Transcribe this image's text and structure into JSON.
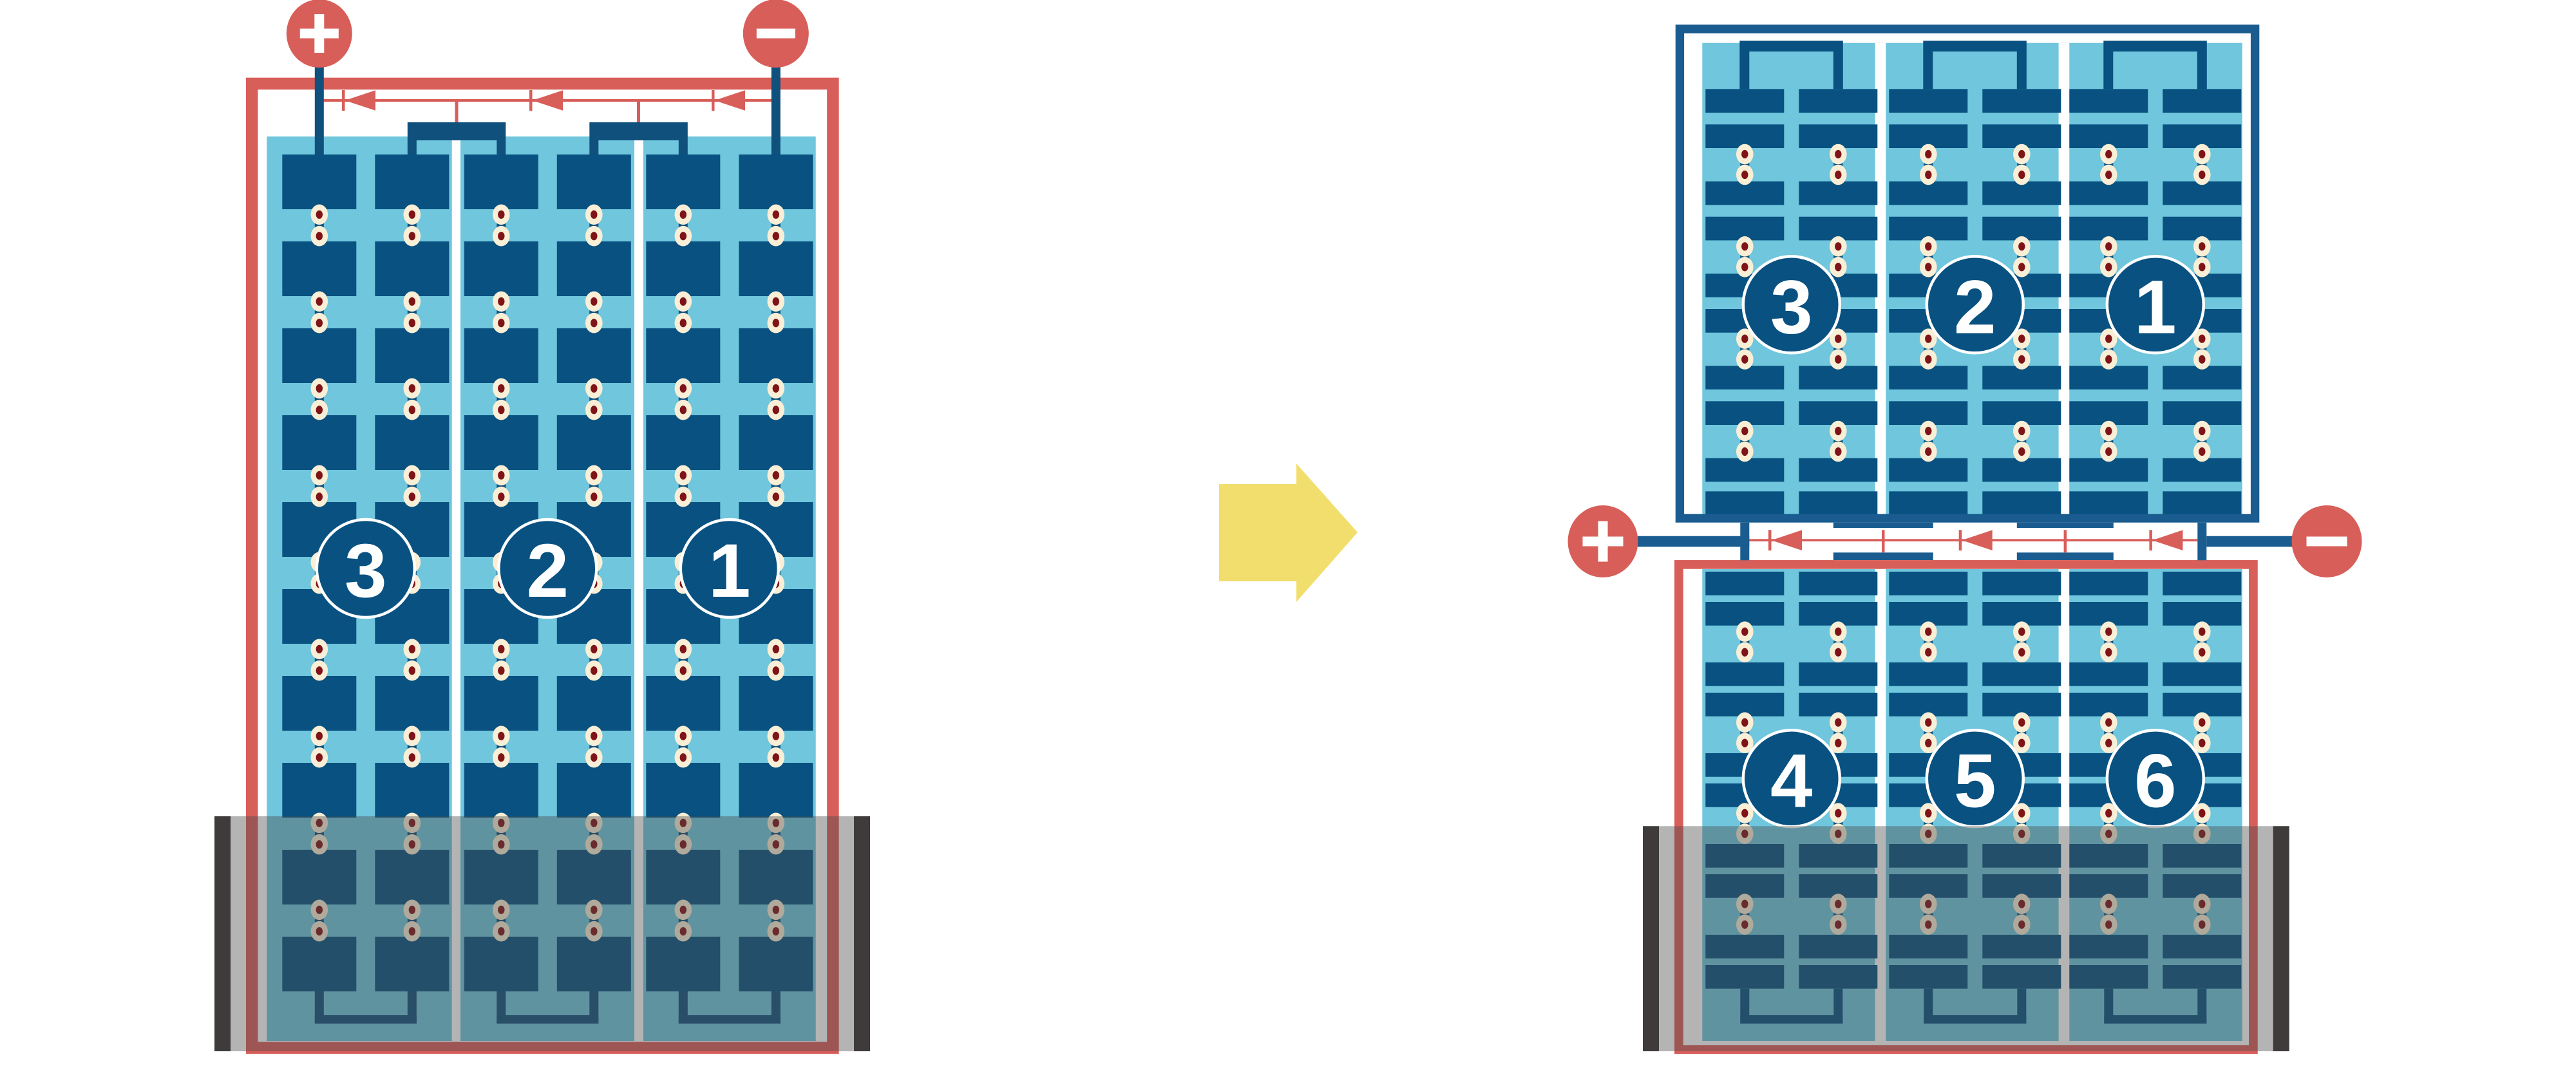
{
  "colors": {
    "cell_navy": "#085180",
    "hw_navy": "#10507D",
    "frame_navy": "#1A5C8F",
    "panel_blue": "#6FC6DD",
    "line_red": "#D85E59",
    "terminal_red": "#D85E59",
    "dot_cream": "#F9EED6",
    "dot_center": "#7E1418",
    "flood_gray": "#4D4D4D",
    "rail_black": "#3E3B3A",
    "arrow_yellow": "#F2DE6D",
    "label_white": "#FFFFFF"
  },
  "left_module": {
    "terminals": [
      {
        "name": "positive",
        "symbol": "+"
      },
      {
        "name": "negative",
        "symbol": "−"
      }
    ],
    "bypass_diode_count": 3,
    "strings": [
      {
        "label": "3"
      },
      {
        "label": "2"
      },
      {
        "label": "1"
      }
    ],
    "flooded_bottom": true
  },
  "transition_arrow": {
    "direction": "right"
  },
  "right_assembly": {
    "terminals": [
      {
        "name": "positive",
        "symbol": "+"
      },
      {
        "name": "negative",
        "symbol": "−"
      }
    ],
    "bypass_diode_count": 3,
    "top_module": {
      "strings": [
        {
          "label": "3"
        },
        {
          "label": "2"
        },
        {
          "label": "1"
        }
      ],
      "flooded_bottom": false
    },
    "bottom_module": {
      "strings": [
        {
          "label": "4"
        },
        {
          "label": "5"
        },
        {
          "label": "6"
        }
      ],
      "flooded_bottom": true
    }
  }
}
